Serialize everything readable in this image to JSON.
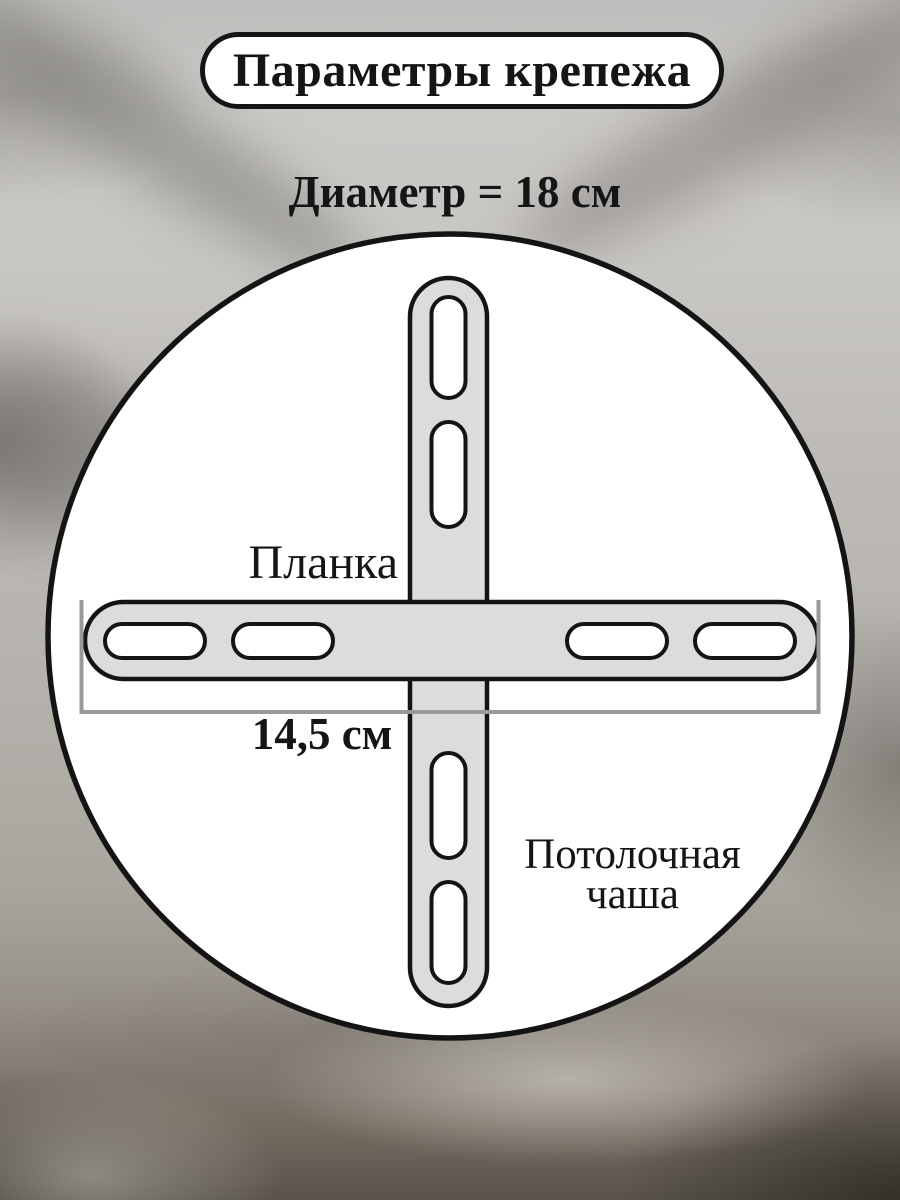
{
  "title": "Параметры крепежа",
  "diagram": {
    "diameter_heading": "Диаметр = 18 см",
    "labels": {
      "plank": "Планка",
      "plank_length": "14,5 см",
      "bowl_line1": "Потолочная",
      "bowl_line2": "чаша"
    },
    "dimensions": {
      "diameter_cm": "18",
      "plank_length_cm": "14,5"
    },
    "colors": {
      "outline": "#141414",
      "circle_fill": "#ffffff",
      "bar_fill": "#dcdcdc",
      "slot_fill": "#ffffff",
      "bracket_line": "#999999"
    }
  }
}
